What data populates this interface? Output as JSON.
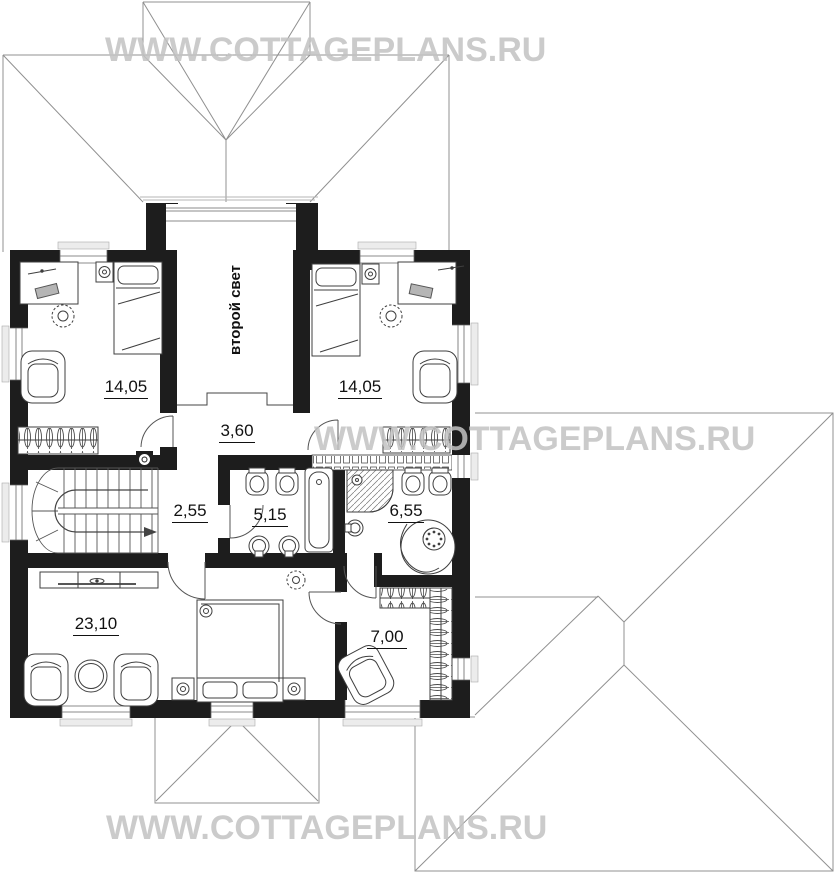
{
  "watermark": {
    "text": "WWW.COTTAGEPLANS.RU",
    "color": "#c3c3c3"
  },
  "plan": {
    "second_light_label": "второй свет",
    "rooms": [
      {
        "id": "bedroom-left",
        "label": "14,05"
      },
      {
        "id": "bedroom-right",
        "label": "14,05"
      },
      {
        "id": "hall",
        "label": "3,60"
      },
      {
        "id": "corridor",
        "label": "2,55"
      },
      {
        "id": "bathroom",
        "label": "5,15"
      },
      {
        "id": "shower-room",
        "label": "6,55"
      },
      {
        "id": "master-bedroom",
        "label": "23,10"
      },
      {
        "id": "wardrobe",
        "label": "7,00"
      }
    ],
    "colors": {
      "wall": "#1d1d1d",
      "roof_line": "#909090",
      "detail_line": "#3f3f3f"
    }
  }
}
